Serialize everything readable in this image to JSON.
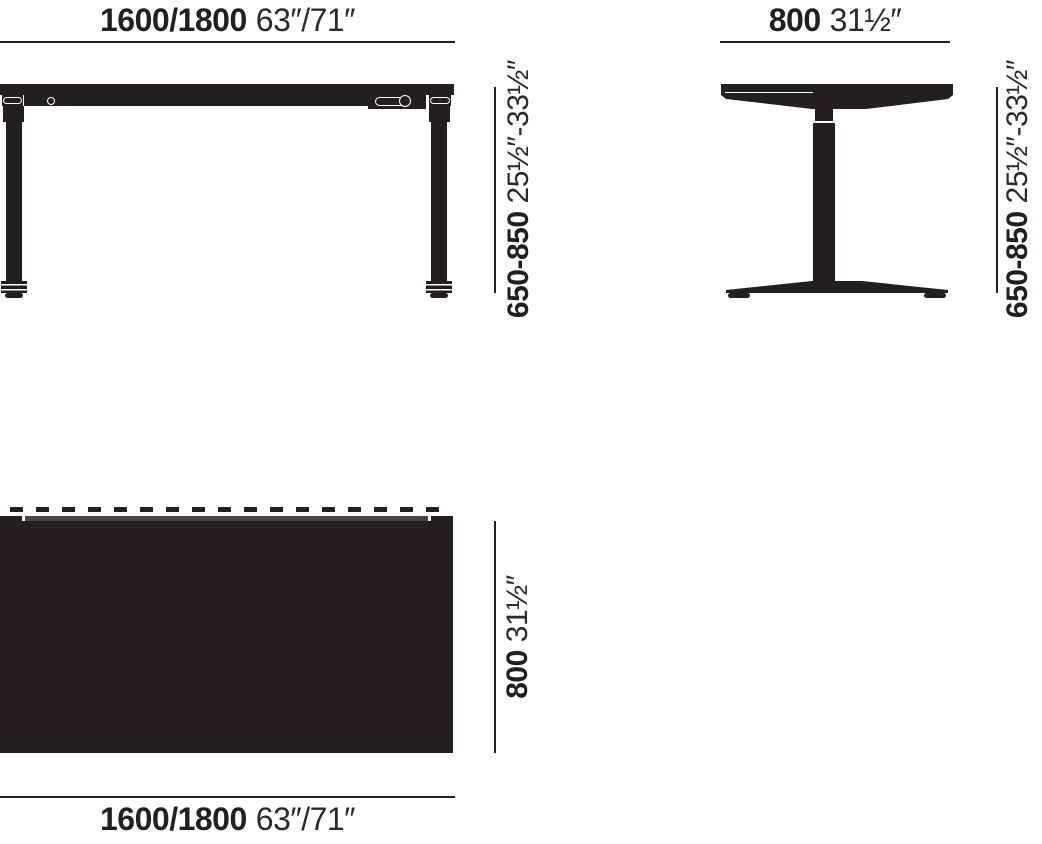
{
  "colors": {
    "ink": "#231f20",
    "background": "#ffffff"
  },
  "views": {
    "front": {
      "name": "front-elevation",
      "width_metric": "1600/1800",
      "width_imperial": "63″/71″",
      "height_metric": "650-850",
      "height_imperial": "25½″-33½″"
    },
    "side": {
      "name": "side-elevation",
      "depth_metric": "800",
      "depth_imperial": "31½″",
      "height_metric": "650-850",
      "height_imperial": "25½″-33½″"
    },
    "top": {
      "name": "top-plan",
      "depth_metric": "800",
      "depth_imperial": "31½″",
      "width_metric": "1600/1800",
      "width_imperial": "63″/71″"
    }
  }
}
